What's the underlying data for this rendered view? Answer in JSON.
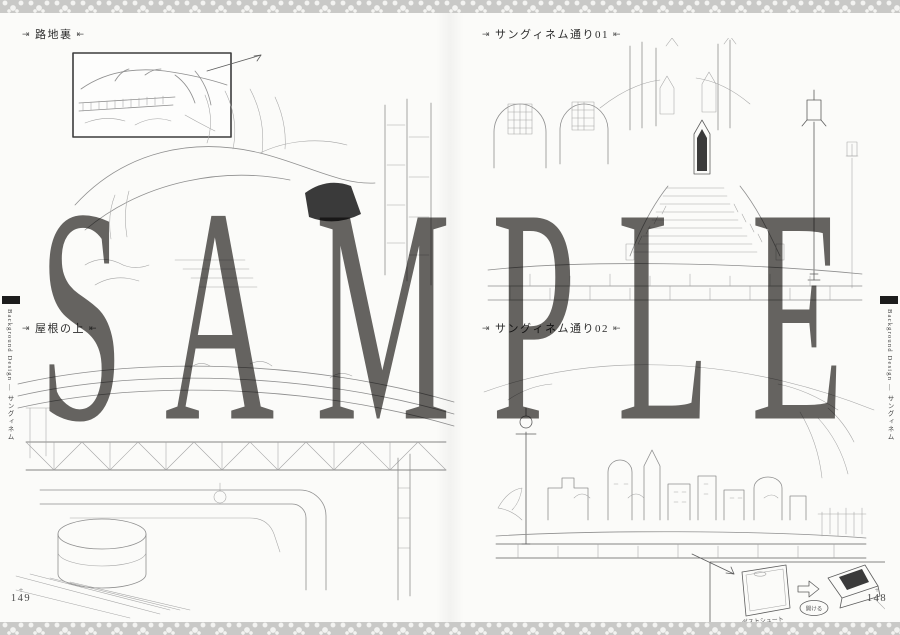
{
  "watermark": "SAMPLE",
  "label_arrows": {
    "before": "⇥",
    "after": "⇤"
  },
  "panels": [
    {
      "id": "alley",
      "label": "路地裏"
    },
    {
      "id": "sanguinem-01",
      "label": "サングィネム通り01"
    },
    {
      "id": "rooftop",
      "label": "屋根の上"
    },
    {
      "id": "sanguinem-02",
      "label": "サングィネム通り02"
    }
  ],
  "sidebar": {
    "text": "Background Design ― サングィネム"
  },
  "page_numbers": {
    "left": "149",
    "right": "148",
    "ornament": "+"
  },
  "chute_diagram": {
    "caption": "ダストシュート",
    "bubble": "開ける"
  },
  "colors": {
    "border_band": "#c9c9c7",
    "watermark_gray": "#666462",
    "ink": "#2d2d2d",
    "pencil": "#8f8f8f"
  }
}
